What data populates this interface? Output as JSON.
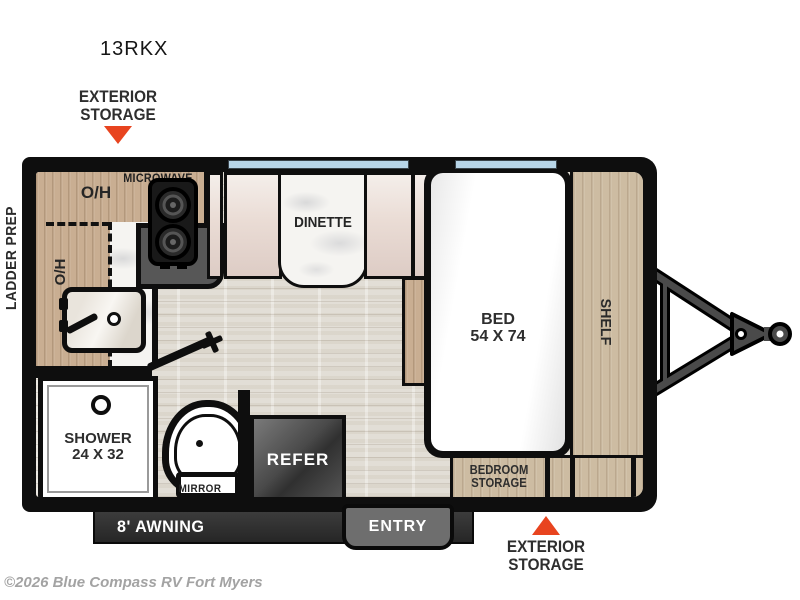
{
  "title": "13RKX",
  "copyright": "©2026 Blue Compass RV Fort Myers",
  "labels": {
    "ladder_prep": "LADDER PREP",
    "exterior_storage_top": [
      "EXTERIOR",
      "STORAGE"
    ],
    "exterior_storage_bottom": [
      "EXTERIOR",
      "STORAGE"
    ],
    "microwave": "MICROWAVE",
    "oh_upper": "O/H",
    "oh_side": "O/H",
    "dinette": "DINETTE",
    "bed": [
      "BED",
      "54 X 74"
    ],
    "shelf": "SHELF",
    "shower": [
      "SHOWER",
      "24 X 32"
    ],
    "mirror": "MIRROR",
    "refer": "REFER",
    "bedroom_storage": [
      "BEDROOM",
      "STORAGE"
    ],
    "awning": "8' AWNING",
    "entry": "ENTRY"
  },
  "colors": {
    "accent_red": "#e8441f",
    "window_blue": "#b7d5e8",
    "wall": "#0e0e0e",
    "wood": "#c9ae92",
    "floor": "#e2ded6",
    "counter_dark": "#575757",
    "awning_dark": "#262626",
    "entry_gray": "#6e6e6e",
    "hitch_gray": "#4a4a4a"
  }
}
